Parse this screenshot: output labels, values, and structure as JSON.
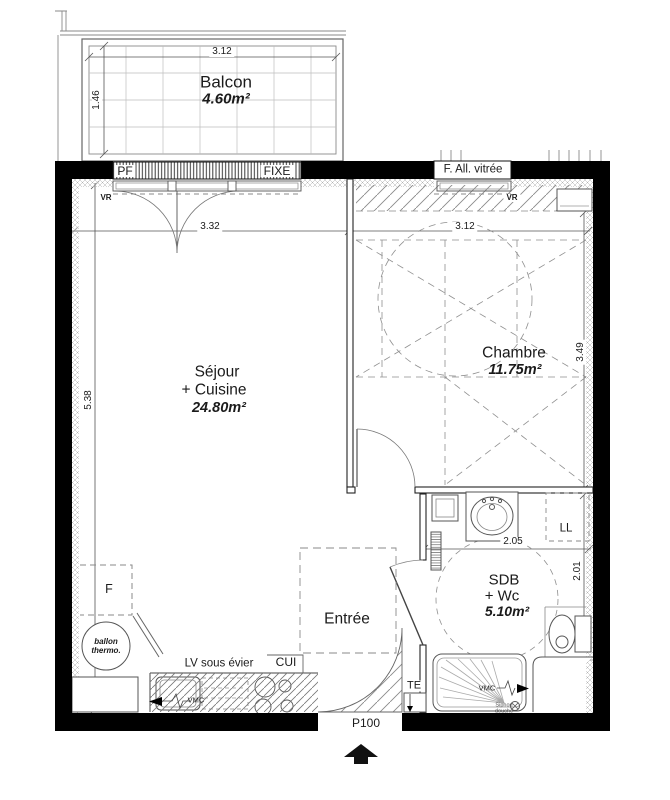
{
  "rooms": {
    "balcony": {
      "name": "Balcon",
      "area": "4.60m²"
    },
    "living": {
      "name_line1": "Séjour",
      "name_line2": "+ Cuisine",
      "area": "24.80m²"
    },
    "bedroom": {
      "name": "Chambre",
      "area": "11.75m²"
    },
    "bathroom": {
      "name_line1": "SDB",
      "name_line2": "+ Wc",
      "area": "5.10m²"
    },
    "entrance": {
      "name": "Entrée"
    }
  },
  "dimensions": {
    "balcony_width": "3.12",
    "balcony_depth": "1.46",
    "living_width": "3.32",
    "living_height": "5.38",
    "bedroom_width": "3.12",
    "bedroom_height": "3.49",
    "bathroom_width": "2.05",
    "bathroom_height": "2.01"
  },
  "openings": {
    "window_pf": "PF",
    "window_fixed": "FIXE",
    "window_glazed": "F. All. vitrée",
    "entry_door": "P100",
    "roller_shutter_left": "VR",
    "roller_shutter_right": "VR"
  },
  "equipment": {
    "washing_machine": "LL",
    "fridge": "F",
    "water_heater_line1": "ballon",
    "water_heater_line2": "thermo.",
    "dishwasher_label": "LV sous évier",
    "cooktop": "CUI",
    "vent_kitchen": "VMC",
    "vent_shower": "VMC",
    "electrical_panel": "TE",
    "shower_drain_line1": "Siphon",
    "shower_drain_line2": "douche"
  },
  "colors": {
    "wall": "#000000",
    "paper": "#ffffff",
    "dash": "#8a8a8a"
  }
}
